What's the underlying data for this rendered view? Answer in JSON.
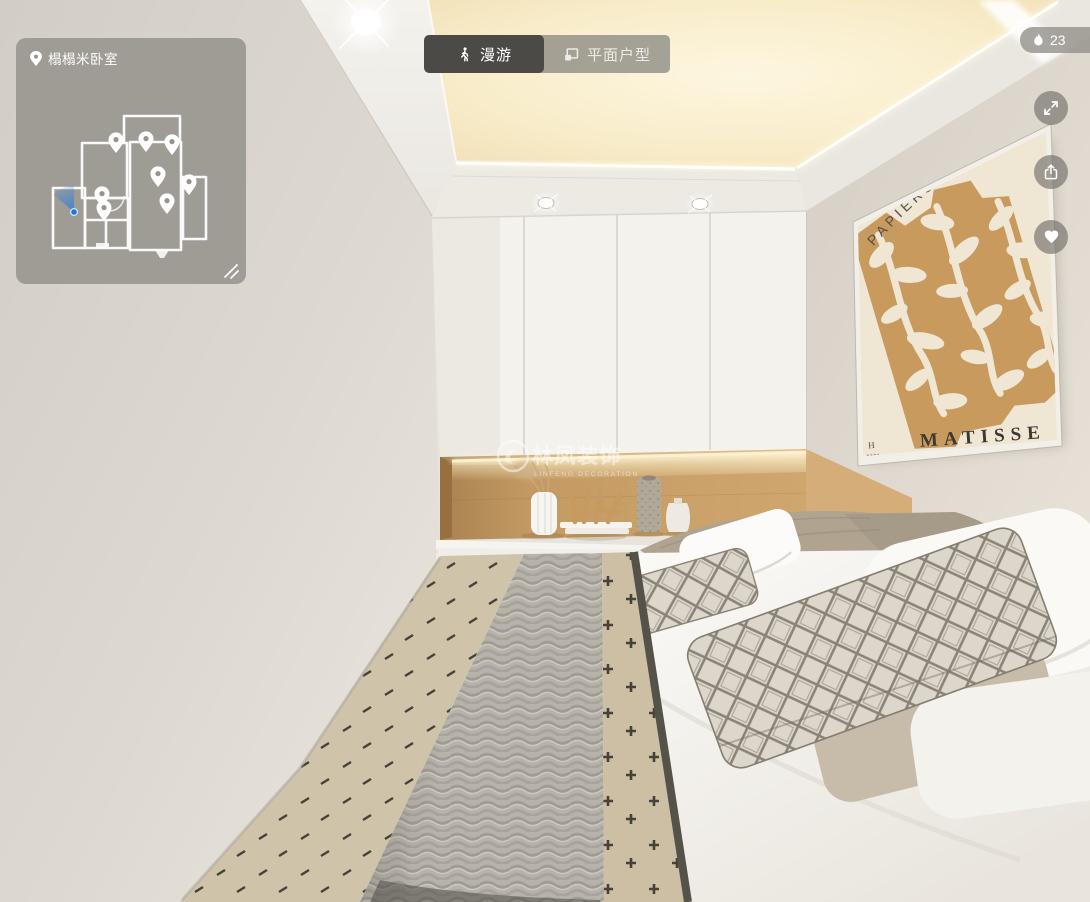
{
  "viewer": {
    "kind": "3d-panorama-room-viewer",
    "heat_count": "23"
  },
  "minimap": {
    "room_label": "榻榻米卧室",
    "pins": [
      {
        "x": 100,
        "y": 115
      },
      {
        "x": 130,
        "y": 114
      },
      {
        "x": 156,
        "y": 117
      },
      {
        "x": 142,
        "y": 149
      },
      {
        "x": 173,
        "y": 157
      },
      {
        "x": 86,
        "y": 169
      },
      {
        "x": 88,
        "y": 183
      },
      {
        "x": 151,
        "y": 176
      }
    ],
    "viewer_position": {
      "x": 58,
      "y": 174
    }
  },
  "tabs": {
    "roam_label": "漫游",
    "floorplan_label": "平面户型",
    "active": "roam"
  },
  "watermark": {
    "brand_zh": "林凤装饰",
    "brand_en": "LINFENG DECORATION"
  },
  "poster": {
    "title": "PAPIERS DÉCOUPÉS",
    "artist": "MATISSE",
    "corner_mark": "H"
  },
  "icons": {
    "location": "map-pin",
    "roam_tab": "walking-person",
    "floorplan_tab": "floorplan-sheet",
    "heat": "flame",
    "fullscreen": "expand-arrows",
    "share": "share-box-arrow",
    "favorite": "heart",
    "minimap_resize": "diagonal-drag-lines",
    "position_marker": "blue-view-cone"
  },
  "colors": {
    "ui_overlay": "rgba(150,147,141,0.85)",
    "ui_active_tab": "#4b4a47",
    "text_light": "#ffffff",
    "cove_glow": "#f8ecc9",
    "niche_wood": "#c49a63",
    "poster_tan": "#c89a5e",
    "viewer_blue": "#2e7fe0"
  }
}
